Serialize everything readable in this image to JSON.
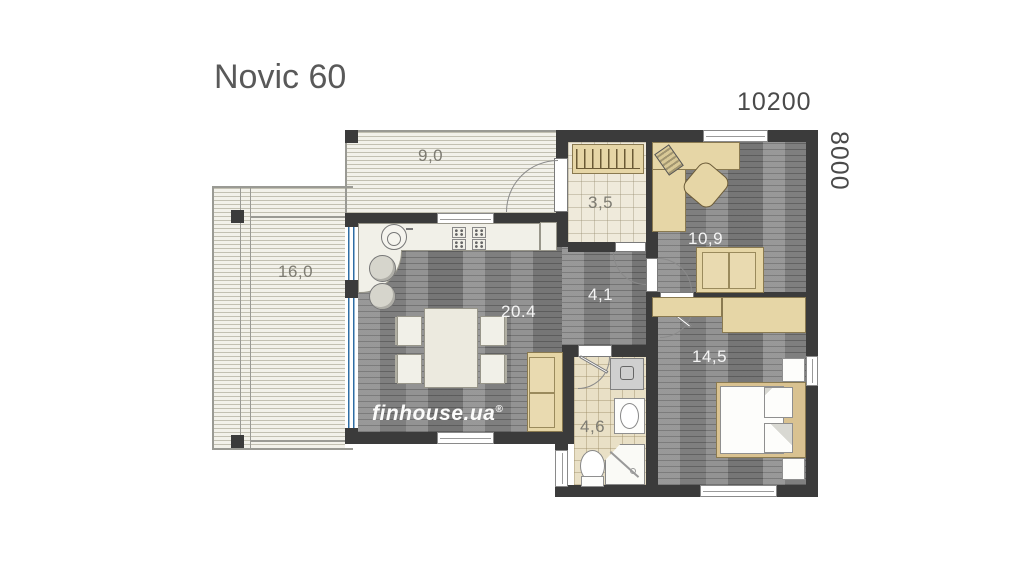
{
  "title": "Novic 60",
  "dimensions": {
    "width": "10200",
    "height": "8000"
  },
  "branding": {
    "logo": "finhouse.ua",
    "mark": "®"
  },
  "rooms": {
    "deck": "9,0",
    "terrace": "16,0",
    "entry": "3,5",
    "office": "10,9",
    "hallway": "4,1",
    "living": "20.4",
    "bedroom": "14,5",
    "bathroom": "4,6"
  },
  "colors": {
    "wall": "#3b3b3b",
    "furniture": "#e6d6a6",
    "glazing_frame": "#2e6da4",
    "wood_floor": "#8d8d8d",
    "tile_floor": "#efeadb",
    "label_light": "#f4f4f4",
    "label_dark": "#7d7b72"
  }
}
